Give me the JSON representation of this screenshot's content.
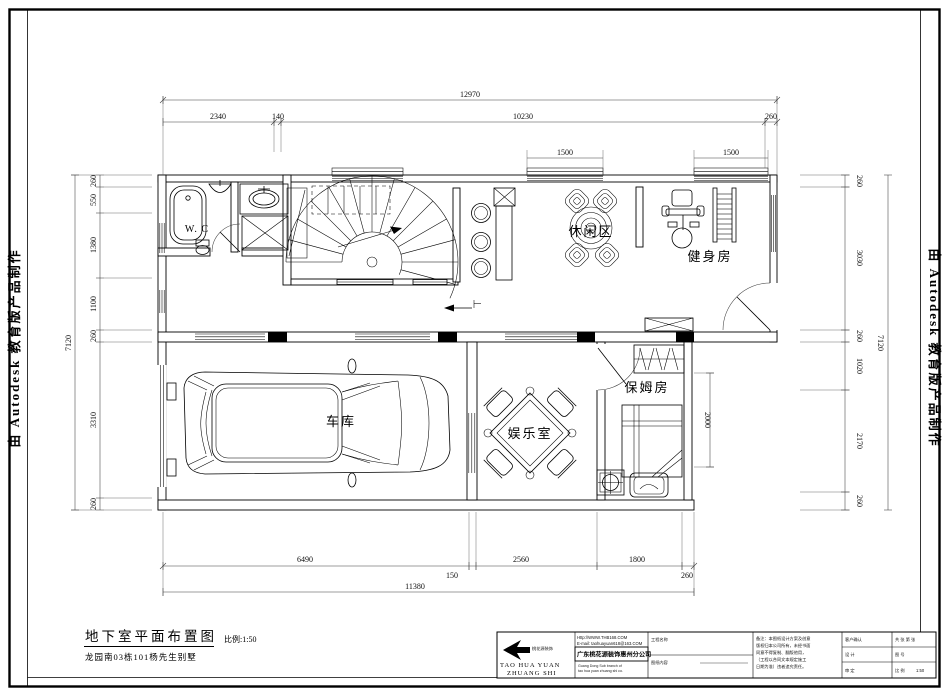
{
  "stamp": {
    "left": "由 Autodesk 教育版产品制作",
    "right": "由 Autodesk 教育版产品制作"
  },
  "rooms": {
    "wc": "W. C",
    "leisure": "休闲区",
    "gym": "健身房",
    "garage": "车库",
    "entertainment": "娱乐室",
    "nanny": "保姆房"
  },
  "dims": {
    "top_total": "12970",
    "top": [
      "2340",
      "140",
      "10230",
      "260"
    ],
    "windows": [
      "1500",
      "1500"
    ],
    "left": [
      "260",
      "550",
      "1380",
      "1100",
      "260",
      "3310",
      "260"
    ],
    "left_total": "7120",
    "right": [
      "260",
      "3030",
      "260",
      "1020",
      "2170",
      "260"
    ],
    "right_total": "7120",
    "bottom": [
      "6490",
      "150",
      "2560",
      "1800",
      "260"
    ],
    "bottom_total": "11380",
    "interior_depth": "2000"
  },
  "footer": {
    "drawing_title": "地下室平面布置图",
    "scale_note": "比例:1:50",
    "project_name": "龙园南03栋101杨先生别墅"
  },
  "titleblock": {
    "logo_text": "桃花源装饰",
    "company_en_1": "TAO HUA YUAN",
    "company_en_2": "ZHUANG SHI",
    "website": "Http://WWW.THB168.COM",
    "email": "E-mail: taohuayuan618@163.COM",
    "company_cn": "广东桃花源装饰惠州分公司",
    "company_sub_en_1": "Guang Dong Sub branch of",
    "company_sub_en_2": "tao hua yuan zhuang shi co.",
    "cell_project_label": "工程名称",
    "cell_content_label": "图纸内容",
    "notes_lines": [
      "备注：本图纸设计方案及创意",
      "版权归本公司所有，未经书面",
      "同意不得复制、翻版他用，",
      "（工程以合同文本规定施工",
      "日期为准）违者追究责任。"
    ],
    "cell_customer_label": "客户确认",
    "cell_design_label": "设  计",
    "cell_approve_label": "审  定",
    "cell_sheets_label": "共 张 第 张",
    "cell_dwgno_label": "图  号",
    "cell_scale_label": "比 例",
    "scale_value": "1:50"
  }
}
